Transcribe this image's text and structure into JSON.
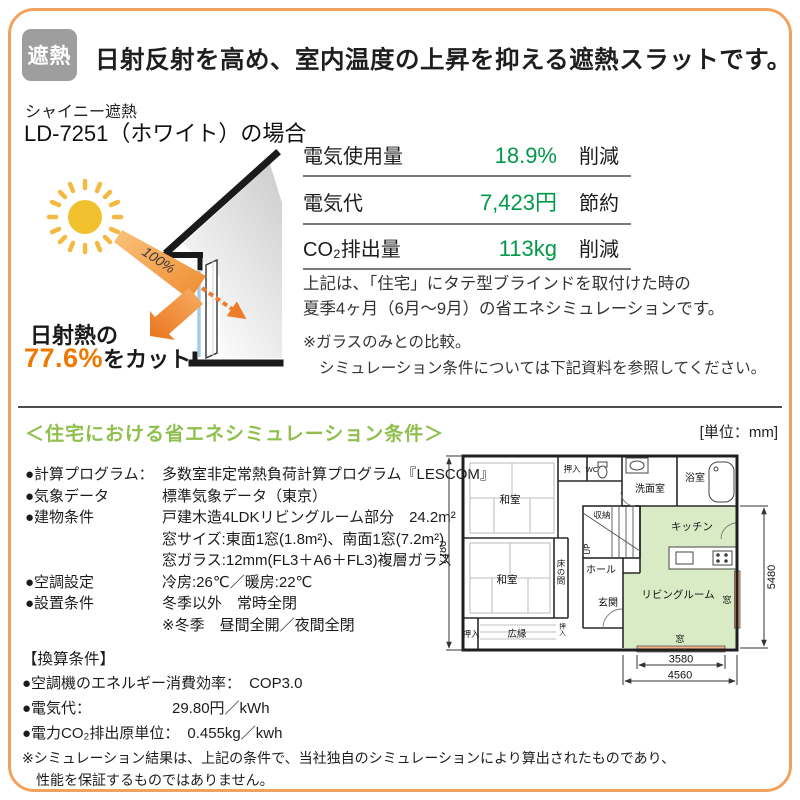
{
  "colors": {
    "frame_border": "#F0A35E",
    "value_green": "#009949",
    "heading_green": "#8FBF4D",
    "highlight_orange": "#EE7800",
    "plan_room_green": "#D9EBC5",
    "plan_window_orange": "#F4B183",
    "badge_gray": "#9E9E9E"
  },
  "header": {
    "badge": "遮熱",
    "title": "日射反射を高め、室内温度の上昇を抑える遮熱スラットです。"
  },
  "product": {
    "series": "シャイニー遮熱",
    "model": "LD-7251（ホワイト）の場合"
  },
  "diagram": {
    "incoming_label": "100%",
    "cut_prefix": "日射熱の",
    "cut_value": "77.6%",
    "cut_suffix": "をカット"
  },
  "savings_table": {
    "rows": [
      {
        "label": "電気使用量",
        "value": "18.9%",
        "action": "削減"
      },
      {
        "label": "電気代",
        "value": "7,423円",
        "action": "節約"
      },
      {
        "label": "CO₂排出量",
        "value": "113kg",
        "action": "削減"
      }
    ]
  },
  "summary": {
    "line1": "上記は、「住宅」にタテ型ブラインドを取付けた時の",
    "line2": "夏季4ヶ月（6月～9月）の省エネシミュレーションです。",
    "note1": "※ガラスのみとの比較。",
    "note2": "シミュレーション条件については下記資料を参照してください。"
  },
  "conditions": {
    "heading": "＜住宅における省エネシミュレーション条件＞",
    "unit_note": "[単位：mm]",
    "items": [
      {
        "label": "●計算プログラム：",
        "value": "多数室非定常熱負荷計算プログラム『LESCOM』"
      },
      {
        "label": "●気象データ",
        "value": "標準気象データ（東京）"
      },
      {
        "label": "●建物条件",
        "value": "戸建木造4LDKリビングルーム部分　24.2m²"
      },
      {
        "label": "",
        "value": "窓サイズ:東面1窓(1.8m²)、南面1窓(7.2m²)"
      },
      {
        "label": "",
        "value": "窓ガラス:12mm(FL3＋A6＋FL3)複層ガラス"
      },
      {
        "label": "●空調設定",
        "value": "冷房:26℃／暖房:22℃"
      },
      {
        "label": "●設置条件",
        "value": "冬季以外　常時全閉"
      },
      {
        "label": "",
        "value": "※冬季　昼間全開／夜間全閉"
      }
    ]
  },
  "conversion": {
    "heading": "【換算条件】",
    "items": [
      {
        "label": "●空調機のエネルギー消費効率：",
        "value": "COP3.0"
      },
      {
        "label": "●電気代：",
        "value": "29.80円／kWh"
      },
      {
        "label": "●電力CO₂排出原単位：",
        "value": "0.455kg／kwh"
      }
    ],
    "footnote1": "※シミュレーション結果は、上記の条件で、当社独自のシミュレーションにより算出されたものであり、",
    "footnote2": "性能を保証するものではありません。"
  },
  "floor_plan": {
    "rooms": {
      "washitsu_top": "和室",
      "washitsu_bottom": "和室",
      "tokonoma": "床の間",
      "oshiire_top": "押入",
      "oshiire_bottom": "押入",
      "oshiire_side": "押入",
      "wc": "WC",
      "senmen": "洗面室",
      "bath": "浴室",
      "kitchen": "キッチン",
      "storage": "収納",
      "up": "UP",
      "hall": "ホール",
      "genkan": "玄関",
      "hiroen": "広縁",
      "living": "リビングルーム",
      "window_right": "窓",
      "window_bottom": "窓"
    },
    "dimensions": {
      "left": "7280",
      "right": "5480",
      "bottom_inner": "3580",
      "bottom_outer": "4560"
    }
  }
}
